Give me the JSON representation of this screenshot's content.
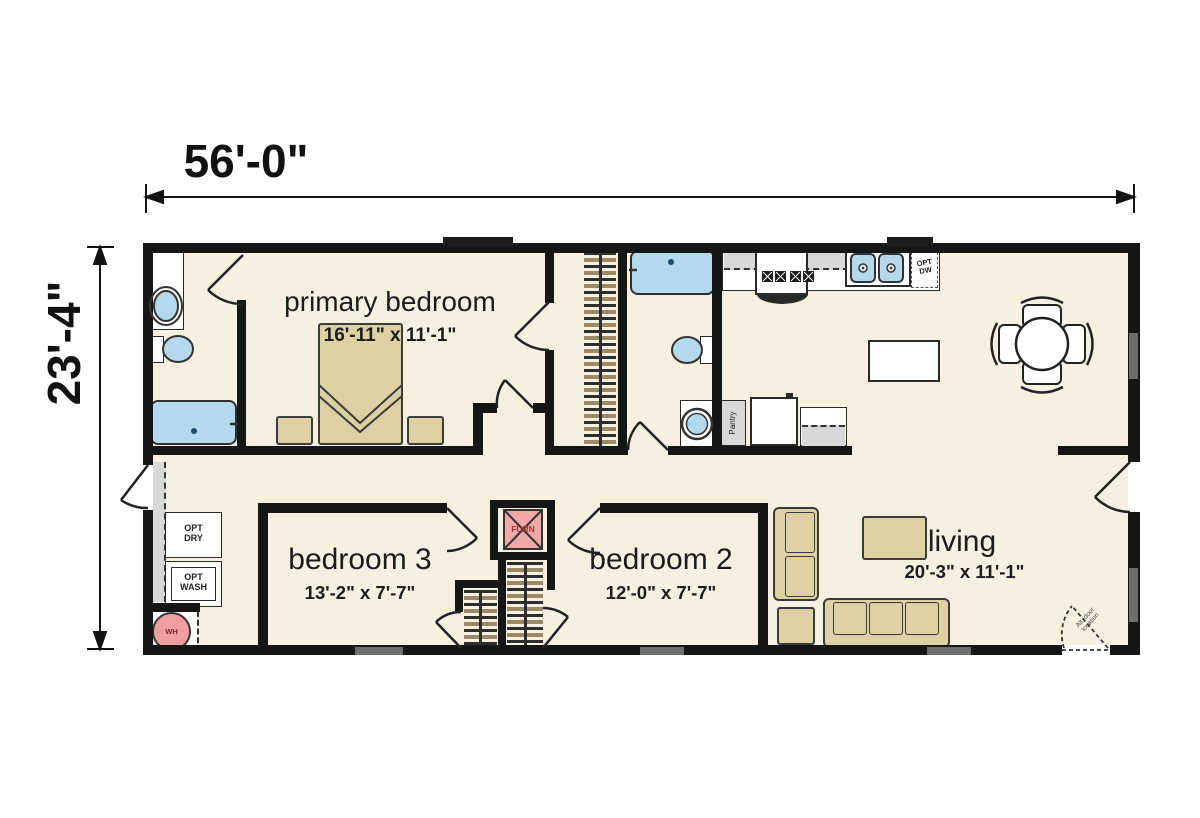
{
  "dimensions": {
    "width_label": "56'-0\"",
    "height_label": "23'-4\""
  },
  "rooms": {
    "primary_bedroom": {
      "name": "primary bedroom",
      "size": "16'-11\" x 11'-1\""
    },
    "bedroom_3": {
      "name": "bedroom 3",
      "size": "13'-2\" x 7'-7\""
    },
    "bedroom_2": {
      "name": "bedroom 2",
      "size": "12'-0\" x 7'-7\""
    },
    "living": {
      "name": "living",
      "size": "20'-3\" x 11'-1\""
    }
  },
  "labels": {
    "opt_dryer": "OPT\nDRY",
    "opt_washer": "OPT\nWASH",
    "water_heater": "WH",
    "furnace": "FURN",
    "pantry": "Pantry",
    "opt_dishwasher": "OPT\nDW",
    "alt_door": "Alt. door\nlocation"
  },
  "colors": {
    "floor": "#f6f0e0",
    "wall": "#161616",
    "fixture_blue": "#b5d9ec",
    "furniture_tan": "#ddd1a4",
    "water_heater_pink": "#ef9f9f",
    "furnace_pink": "#f0a8a8",
    "counter_gray": "#d8d8d8"
  }
}
